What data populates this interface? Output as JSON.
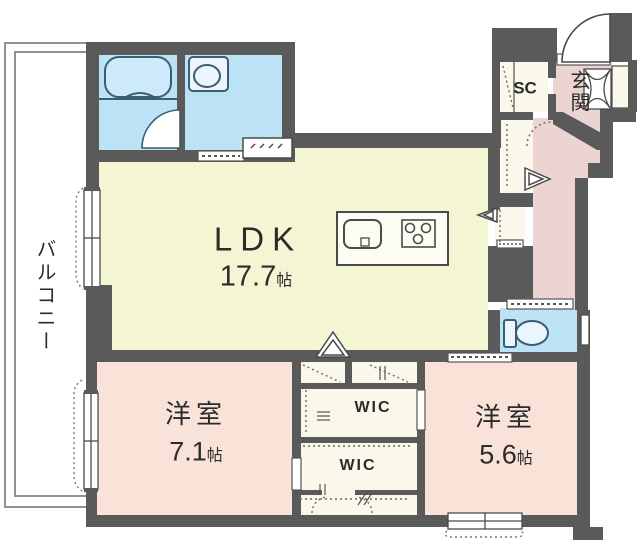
{
  "title": "apartment-floor-plan",
  "rooms": {
    "ldk": {
      "name": "LDK",
      "area": "17.7",
      "unit": "帖"
    },
    "bedroom_left": {
      "name": "洋室",
      "area": "7.1",
      "unit": "帖"
    },
    "bedroom_right": {
      "name": "洋室",
      "area": "5.6",
      "unit": "帖"
    },
    "wic_upper": {
      "name": "WIC"
    },
    "wic_lower": {
      "name": "WIC"
    },
    "shoe_closet": {
      "name": "SC"
    },
    "entrance": {
      "name": "玄関"
    },
    "balcony": {
      "name": "バルコニー"
    }
  },
  "fixtures": [
    "bathtub",
    "bath-door",
    "wash-basin",
    "washing-machine-space",
    "kitchen-island",
    "kitchen-sink",
    "gas-stove",
    "toilet",
    "entrance-door",
    "shoe-cabinet",
    "mirror-cabinet",
    "fold-door-symbol",
    "sliding-door",
    "window",
    "closet-hanger-pipe"
  ],
  "colors": {
    "wall": "#5a5a5a",
    "ldk": "#f4f6d3",
    "bed": "#f9e2d8",
    "hall": "#ecd4d2",
    "wet": "#bce2f5",
    "closet": "#faf8ea",
    "line": "#4a4a4a",
    "fix": "#3b5d72",
    "balcony_line": "#919191",
    "text": "#2b2b2b"
  }
}
